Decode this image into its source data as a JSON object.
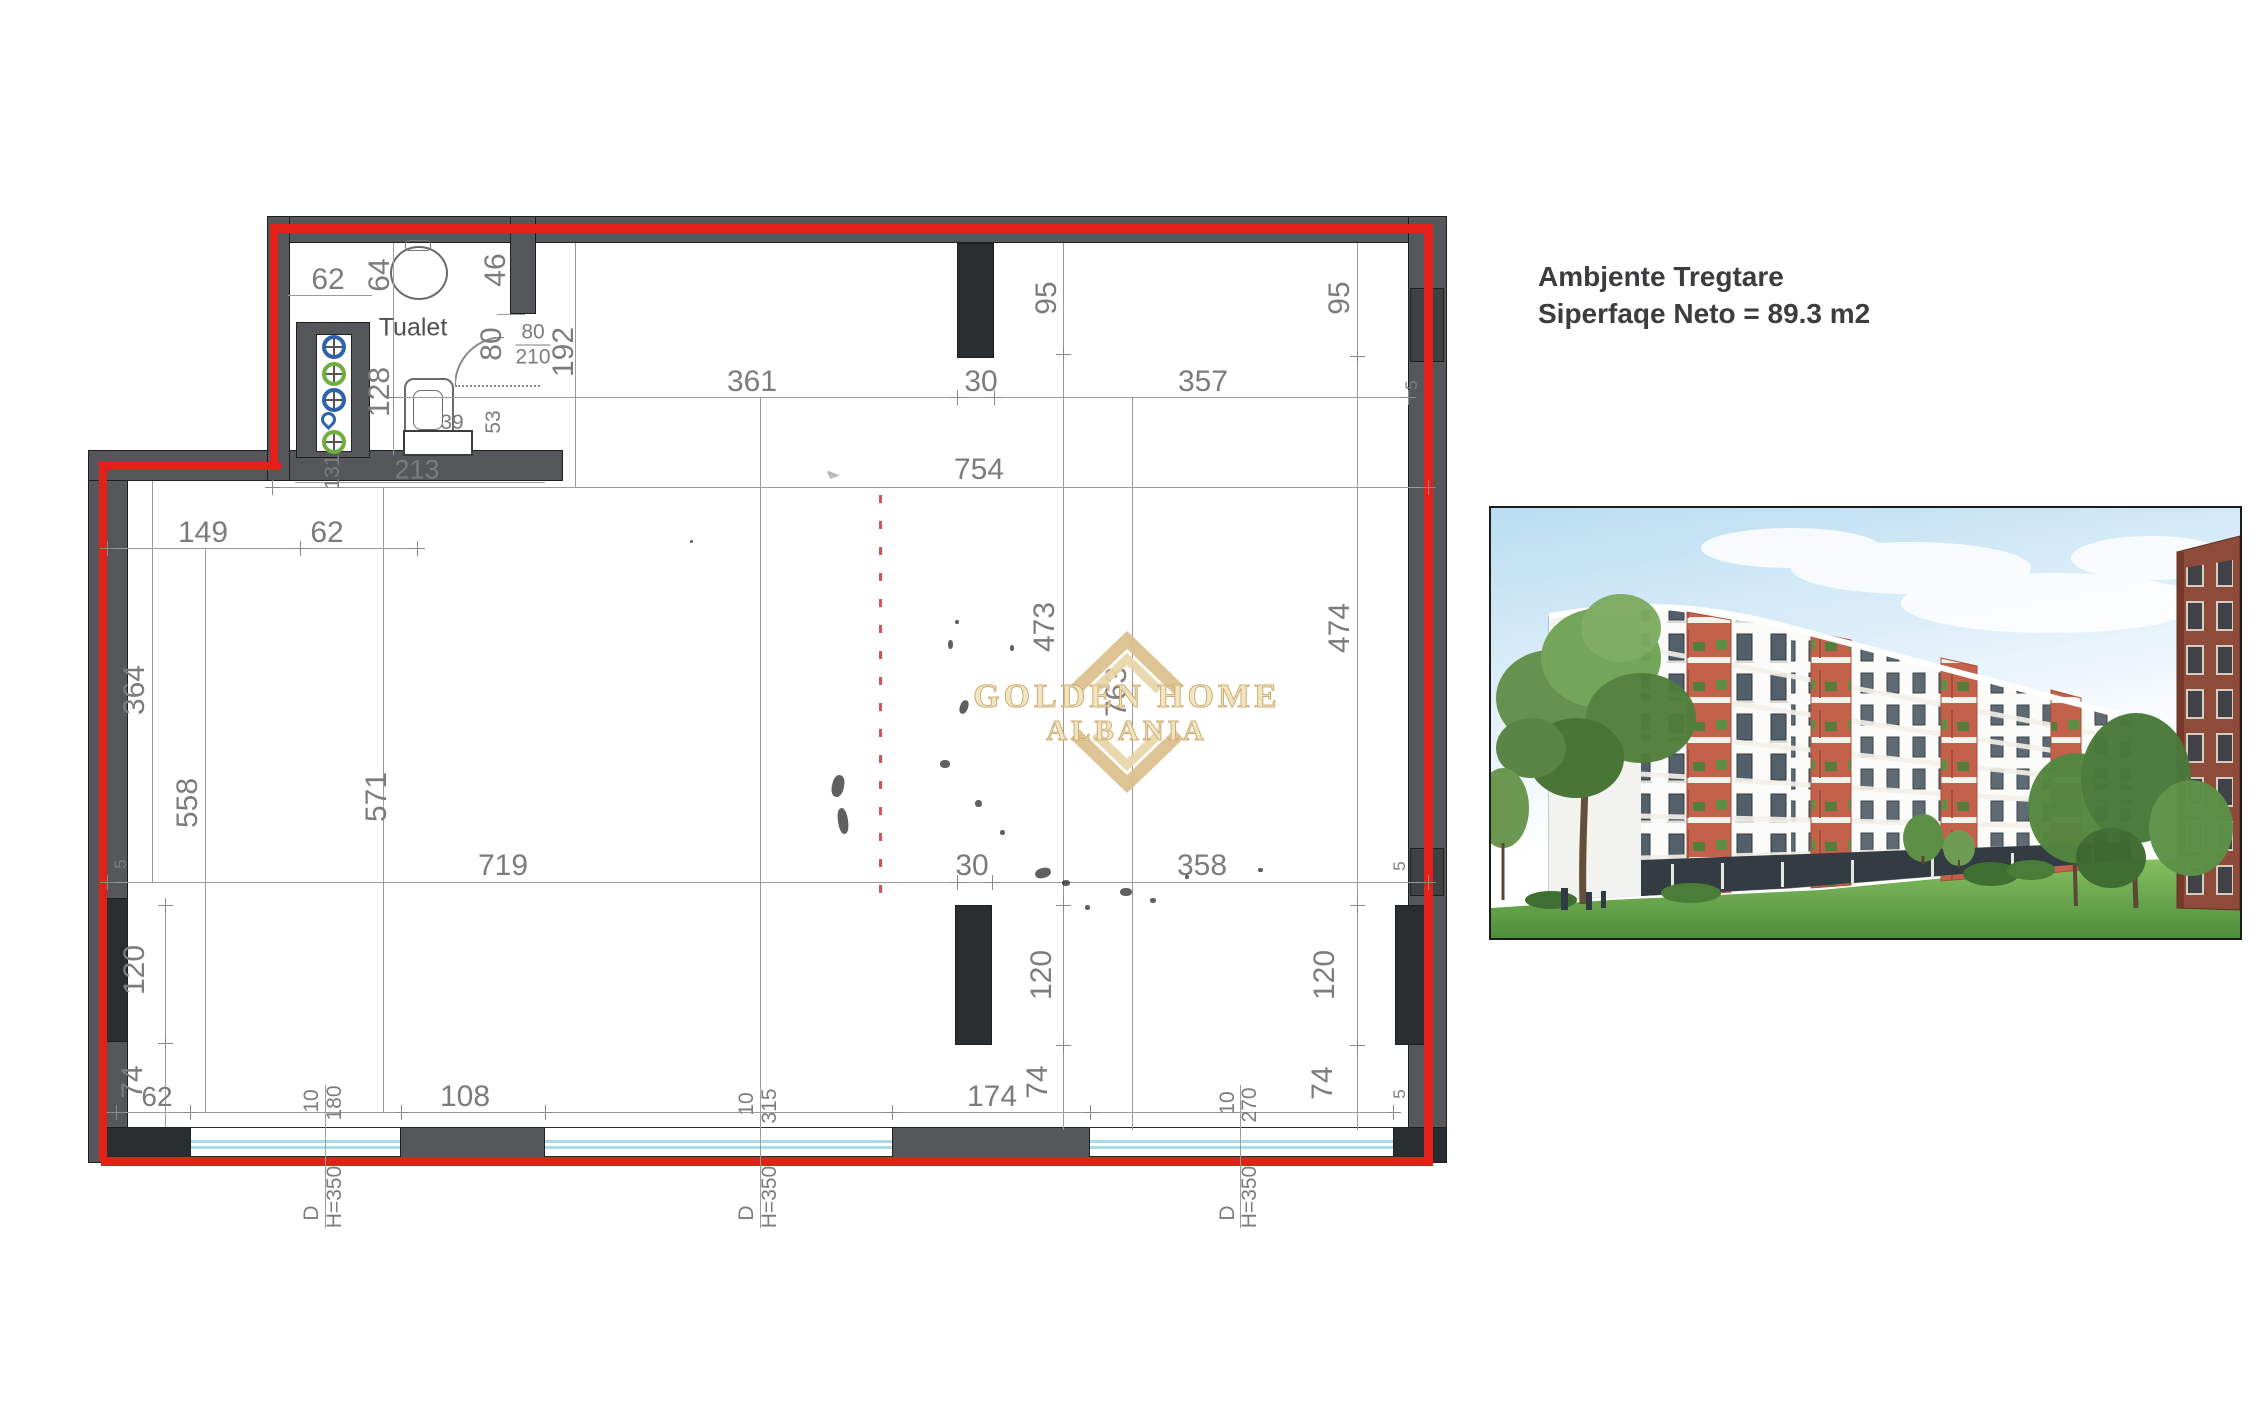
{
  "title": {
    "line1": "Ambjente Tregtare",
    "line2": "Siperfaqe Neto = 89.3 m2"
  },
  "watermark": {
    "line1": "GOLDEN HOME",
    "line2": "ALBANIA",
    "gold": "#d9be8c"
  },
  "plan": {
    "room_label": "Tualet",
    "boundary_color": "#e32119",
    "wall_color": "#55575b",
    "column_color": "#2b2e30",
    "dim_color": "#7c7c7c",
    "glass_color": "#a8dce6"
  },
  "dims": {
    "toilet_62": "62",
    "toilet_64": "64",
    "toilet_46": "46",
    "toilet_128": "128",
    "toilet_80": "80",
    "door_w": "80",
    "door_h": "210",
    "toilet_192": "192",
    "toilet_39": "39",
    "toilet_53": "53",
    "toilet_213": "213",
    "shaft_131": "131",
    "top_361": "361",
    "top_30": "30",
    "top_357": "357",
    "top_95l": "95",
    "top_95r": "95",
    "top_754": "754",
    "side_5a": "5",
    "side_5b": "5",
    "side_5c": "5",
    "side_5d": "5",
    "left_149": "149",
    "left_62": "62",
    "left_364": "364",
    "left_558": "558",
    "left_571": "571",
    "mid_719": "719",
    "mid_30": "30",
    "mid_358": "358",
    "mid_473": "473",
    "mid_763": "763",
    "mid_474": "474",
    "bl_120": "120",
    "bl_74": "74",
    "bl_62": "62",
    "bl_108": "108",
    "bm_174": "174",
    "bm_74": "74",
    "bm_120": "120",
    "br_120": "120",
    "br_74": "74"
  },
  "window_tags": {
    "a": {
      "t": "10",
      "b": "180"
    },
    "b": {
      "t": "10",
      "b": "315"
    },
    "c": {
      "t": "10",
      "b": "270"
    }
  },
  "door_tag": {
    "d": "D",
    "h": "H=350"
  },
  "photo": {
    "alt": "apartment-building-render",
    "sky": "#b9ddf1",
    "grass": "#5f9c45",
    "accent": "#c4614a",
    "brick": "#8f4b3a"
  }
}
